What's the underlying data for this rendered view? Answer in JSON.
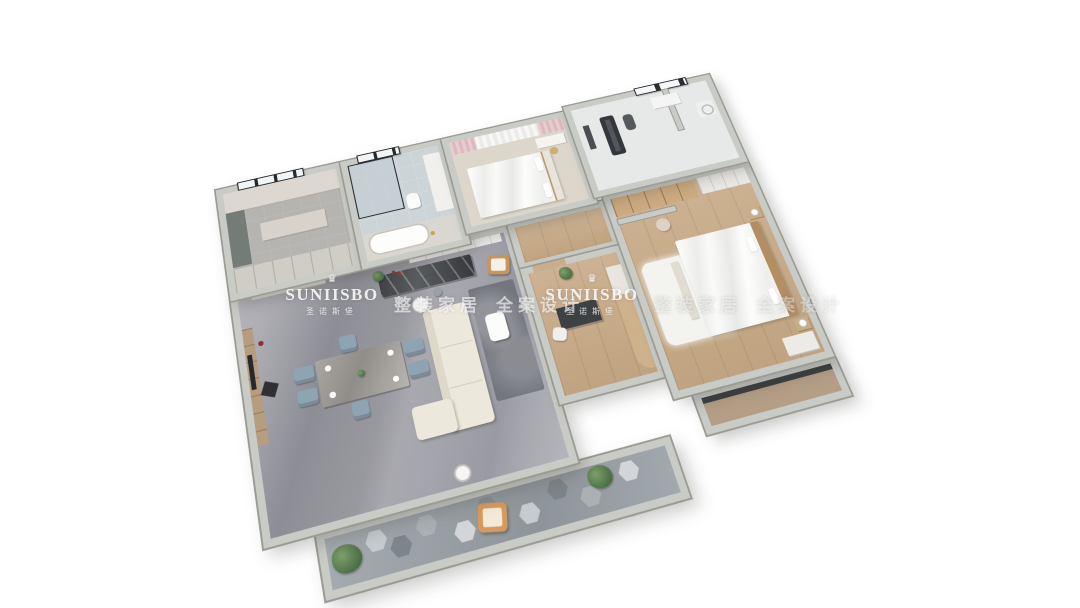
{
  "brand": {
    "name": "SUNIISBO",
    "name_cn": "圣诺斯堡",
    "crown_icon": "♛"
  },
  "watermark": {
    "tagline_a": "整装家居",
    "tagline_b": "全案设计"
  },
  "palette": {
    "background": "#ffffff",
    "wall": "#c9cbc6",
    "wall_edge": "#9a9c93",
    "marble_floor": "#97979e",
    "wood_floor": "#c9ae8e",
    "bedroom_floor": "#dcd6cb",
    "bath_tile": "#cdd4d8",
    "sofa_cream": "#ece8db",
    "dining_chair_blue": "#8ea4b2",
    "armchair_orange": "#d89a5c",
    "curtain_pink": "#e0bfc3",
    "plant_green": "#567a4e",
    "watermark_white": "#fdfdfc"
  }
}
